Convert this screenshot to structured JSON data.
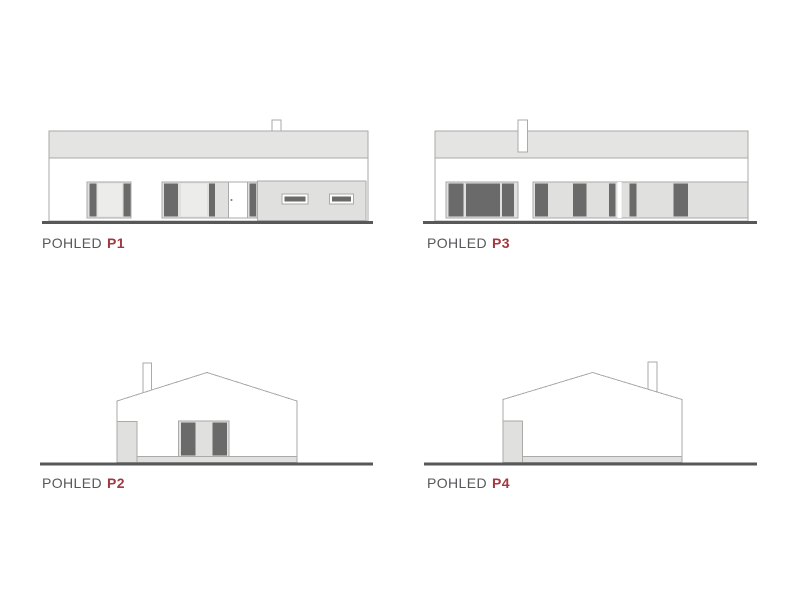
{
  "colors": {
    "outline": "#aaaaaa",
    "roof_band": "#e4e4e2",
    "panel_light": "#e0e0de",
    "panel_lighter": "#ececea",
    "pane_dark": "#6a6a6a",
    "ground": "#58585a",
    "label": "#57585b",
    "accent": "#a23940",
    "background": "#ffffff"
  },
  "elevations": [
    {
      "label": "POHLED",
      "code": "P1"
    },
    {
      "label": "POHLED",
      "code": "P3"
    },
    {
      "label": "POHLED",
      "code": "P2"
    },
    {
      "label": "POHLED",
      "code": "P4"
    }
  ]
}
